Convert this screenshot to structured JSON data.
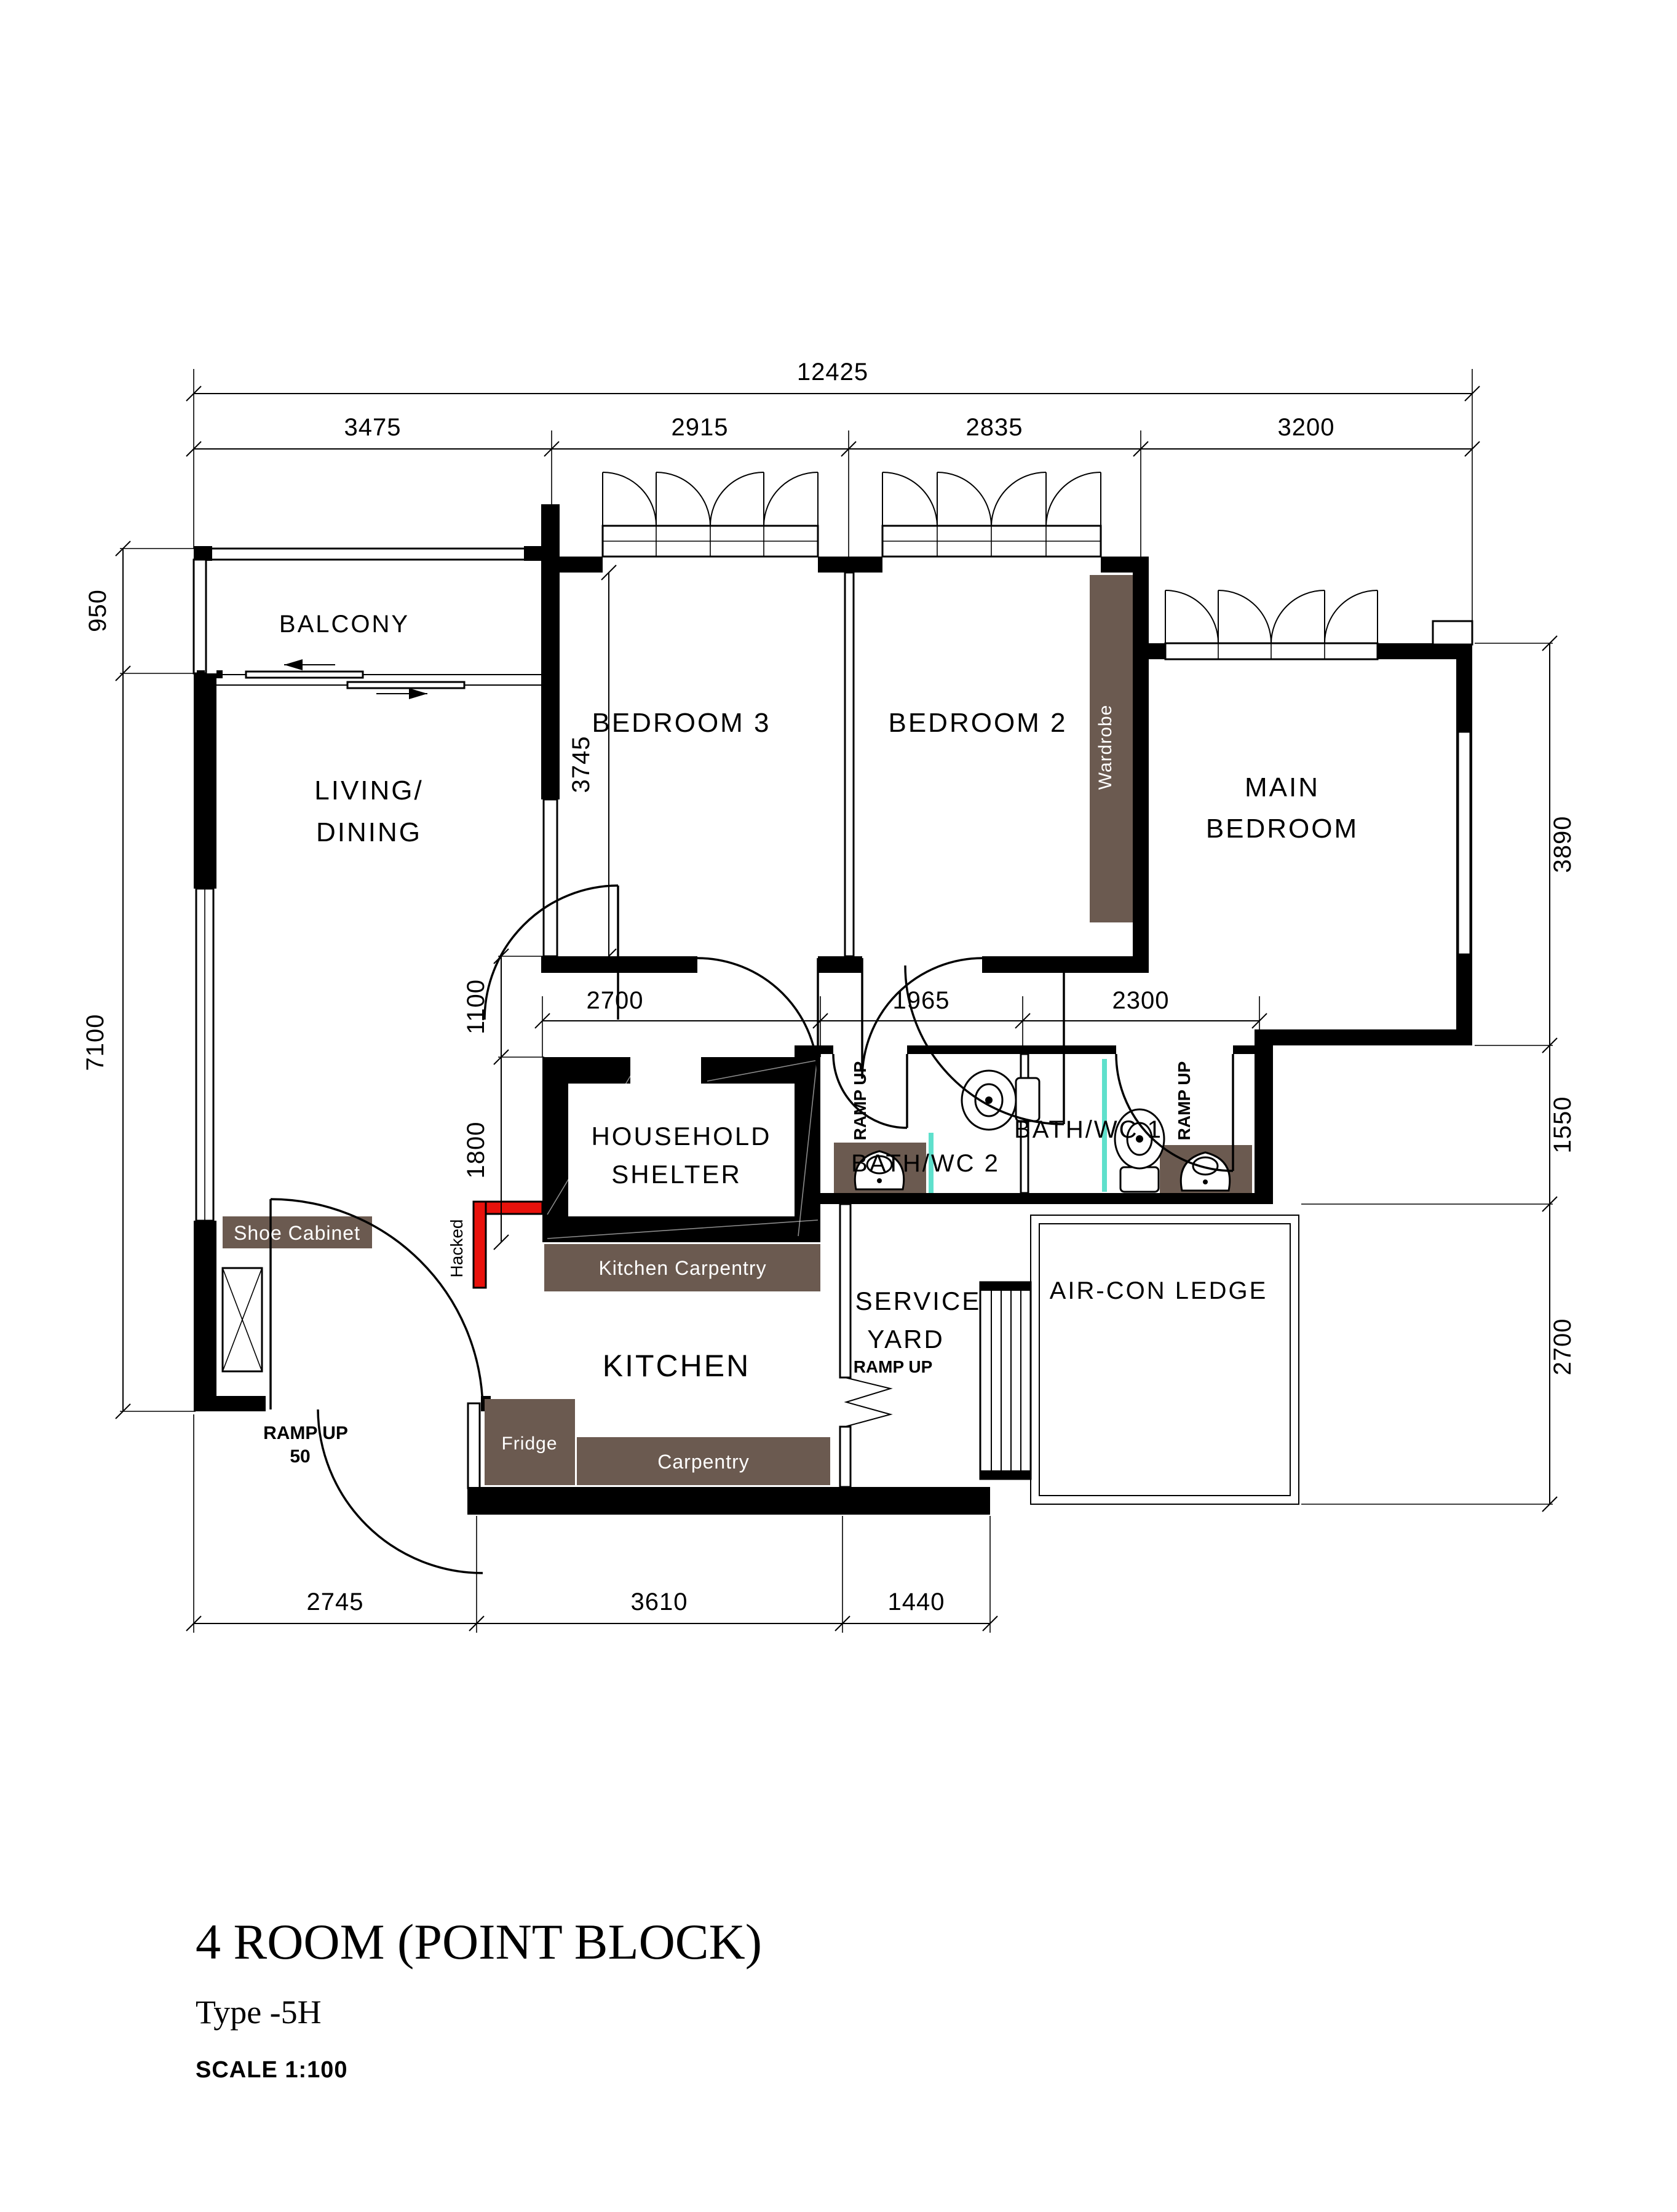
{
  "document": {
    "title": "4 ROOM (POINT BLOCK)",
    "type_line": "Type -5H",
    "scale_line": "SCALE 1:100"
  },
  "rooms": {
    "balcony": "BALCONY",
    "living_line1": "LIVING/",
    "living_line2": "DINING",
    "bedroom3": "BEDROOM 3",
    "bedroom2": "BEDROOM 2",
    "main_line1": "MAIN",
    "main_line2": "BEDROOM",
    "shelter_line1": "HOUSEHOLD",
    "shelter_line2": "SHELTER",
    "bath2": "BATH/WC 2",
    "bath1": "BATH/WC 1",
    "kitchen": "KITCHEN",
    "service_line1": "SERVICE",
    "service_line2": "YARD",
    "aircon": "AIR-CON LEDGE"
  },
  "furniture": {
    "wardrobe": "Wardrobe",
    "shoe_cabinet": "Shoe Cabinet",
    "kitchen_carpentry": "Kitchen Carpentry",
    "fridge": "Fridge",
    "carpentry": "Carpentry"
  },
  "annotations": {
    "hacked": "Hacked",
    "ramp_up": "RAMP UP",
    "ramp_up_50_line1": "RAMP UP",
    "ramp_up_50_line2": "50"
  },
  "dimensions": {
    "overall_width": "12425",
    "top_segments": [
      "3475",
      "2915",
      "2835",
      "3200"
    ],
    "left_segments": [
      "950",
      "7100"
    ],
    "right_segments": [
      "3890",
      "1550",
      "2700"
    ],
    "bottom_segments": [
      "2745",
      "3610",
      "1440"
    ],
    "inner_horizontal": [
      "2700",
      "1965",
      "2300"
    ],
    "inner_vertical": [
      "1100",
      "1800"
    ],
    "bedroom3_depth": "3745"
  },
  "colors": {
    "wall": "#000000",
    "carpentry_brown": "#6B5A50",
    "hacked_red": "#E8120C",
    "shower_screen_teal": "#5FE0CC",
    "paper": "#FFFFFF"
  }
}
